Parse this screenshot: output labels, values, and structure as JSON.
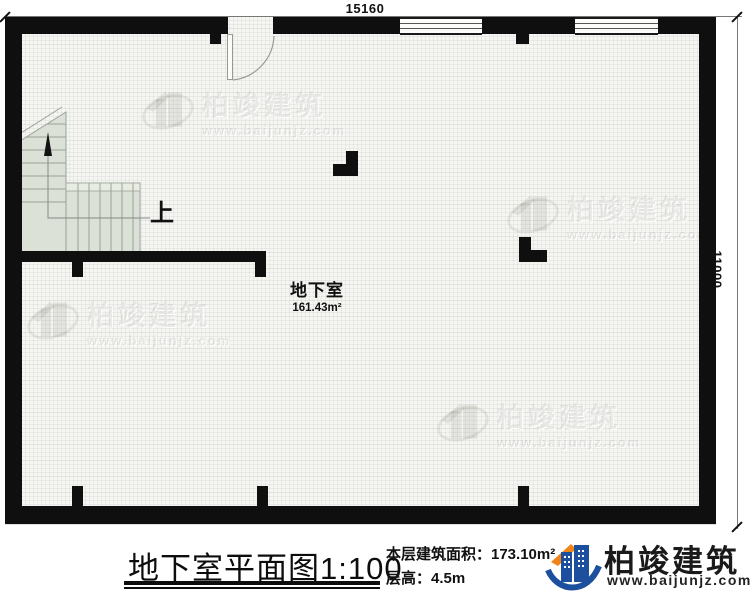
{
  "plan": {
    "dim_top": "15160",
    "dim_right": "11000",
    "room": {
      "name": "地下室",
      "area": "161.43m²"
    },
    "stairs_label": "上"
  },
  "titleblock": {
    "title": "地下室平面图",
    "scale": "1:100",
    "area_info": "本层建筑面积：173.10m²",
    "floor_height": "层高：4.5m"
  },
  "brand": {
    "name": "柏竣建筑",
    "url": "www.baijunjz.com"
  },
  "watermark": {
    "name": "柏竣建筑",
    "url": "www.baijunjz.com"
  },
  "colors": {
    "wall": "#0f0f0f",
    "floor": "#f5f5f2",
    "stair_fill": "#dbe1d6",
    "brand_blue": "#1d4f9f",
    "brand_orange": "#f08419"
  }
}
